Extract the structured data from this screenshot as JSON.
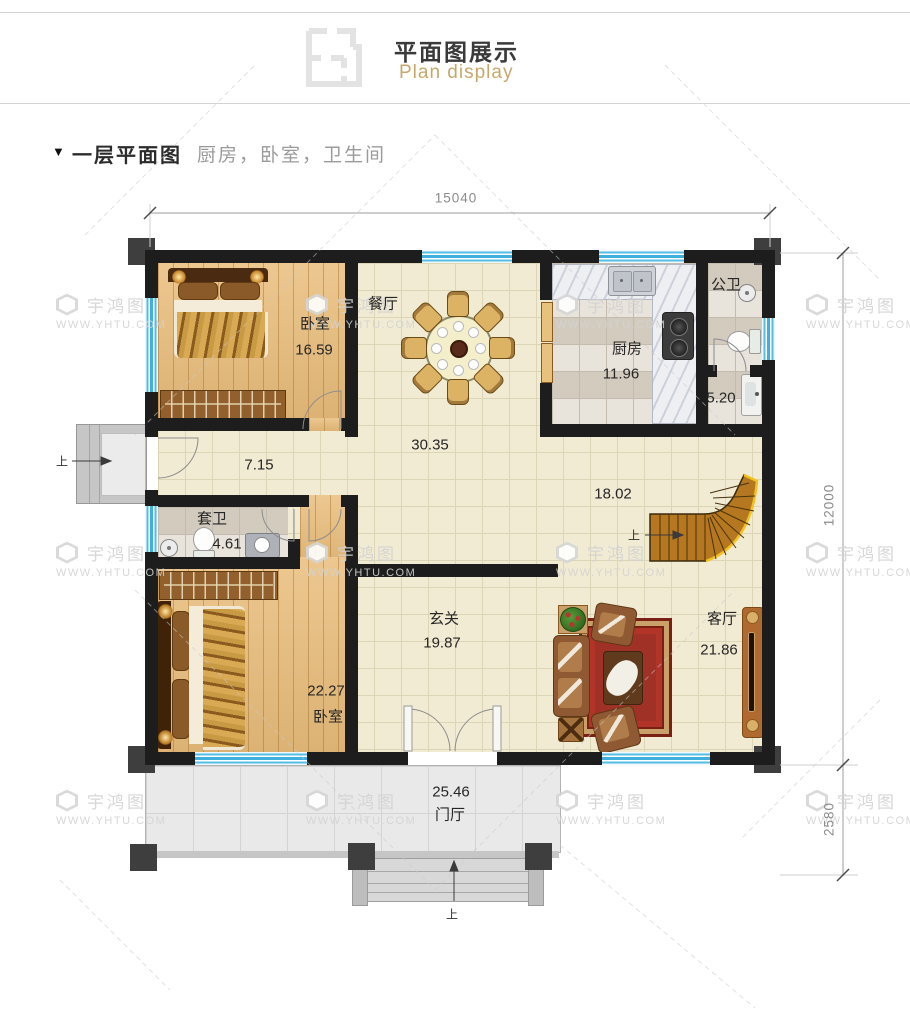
{
  "header": {
    "title": "平面图展示",
    "subtitle": "Plan display"
  },
  "section": {
    "marker": "▼",
    "title": "一层平面图",
    "tags": "厨房，卧室，卫生间"
  },
  "dimensions": {
    "total_width": "15040",
    "main_depth": "12000",
    "porch_depth": "2580"
  },
  "rooms": {
    "bedroom1": {
      "label": "卧室",
      "area": "16.59"
    },
    "dining": {
      "label": "餐厅"
    },
    "hall": {
      "area": "30.35"
    },
    "corridor": {
      "area": "7.15"
    },
    "kitchen": {
      "label": "厨房",
      "area": "11.96"
    },
    "public_bath": {
      "label": "公卫"
    },
    "bath_alcove": {
      "area": "5.20"
    },
    "stair_hall": {
      "area": "18.02"
    },
    "ensuite_bath": {
      "label": "套卫",
      "area": "4.61"
    },
    "bedroom2": {
      "label": "卧室",
      "area": "22.27"
    },
    "foyer": {
      "label": "玄关",
      "area": "19.87"
    },
    "living": {
      "label": "客厅",
      "area": "21.86"
    },
    "porch": {
      "label": "门厅",
      "area": "25.46"
    }
  },
  "markers": {
    "up": "上"
  },
  "watermark": {
    "name": "宇鸿图",
    "url": "WWW.YHTU.COM"
  },
  "colors": {
    "accent_gold": "#c7a86a",
    "wall": "#1d1d1d",
    "window_blue": "#3fb0dd",
    "wood_floor": "#eac183",
    "tile_cream": "#f1ebd3"
  }
}
